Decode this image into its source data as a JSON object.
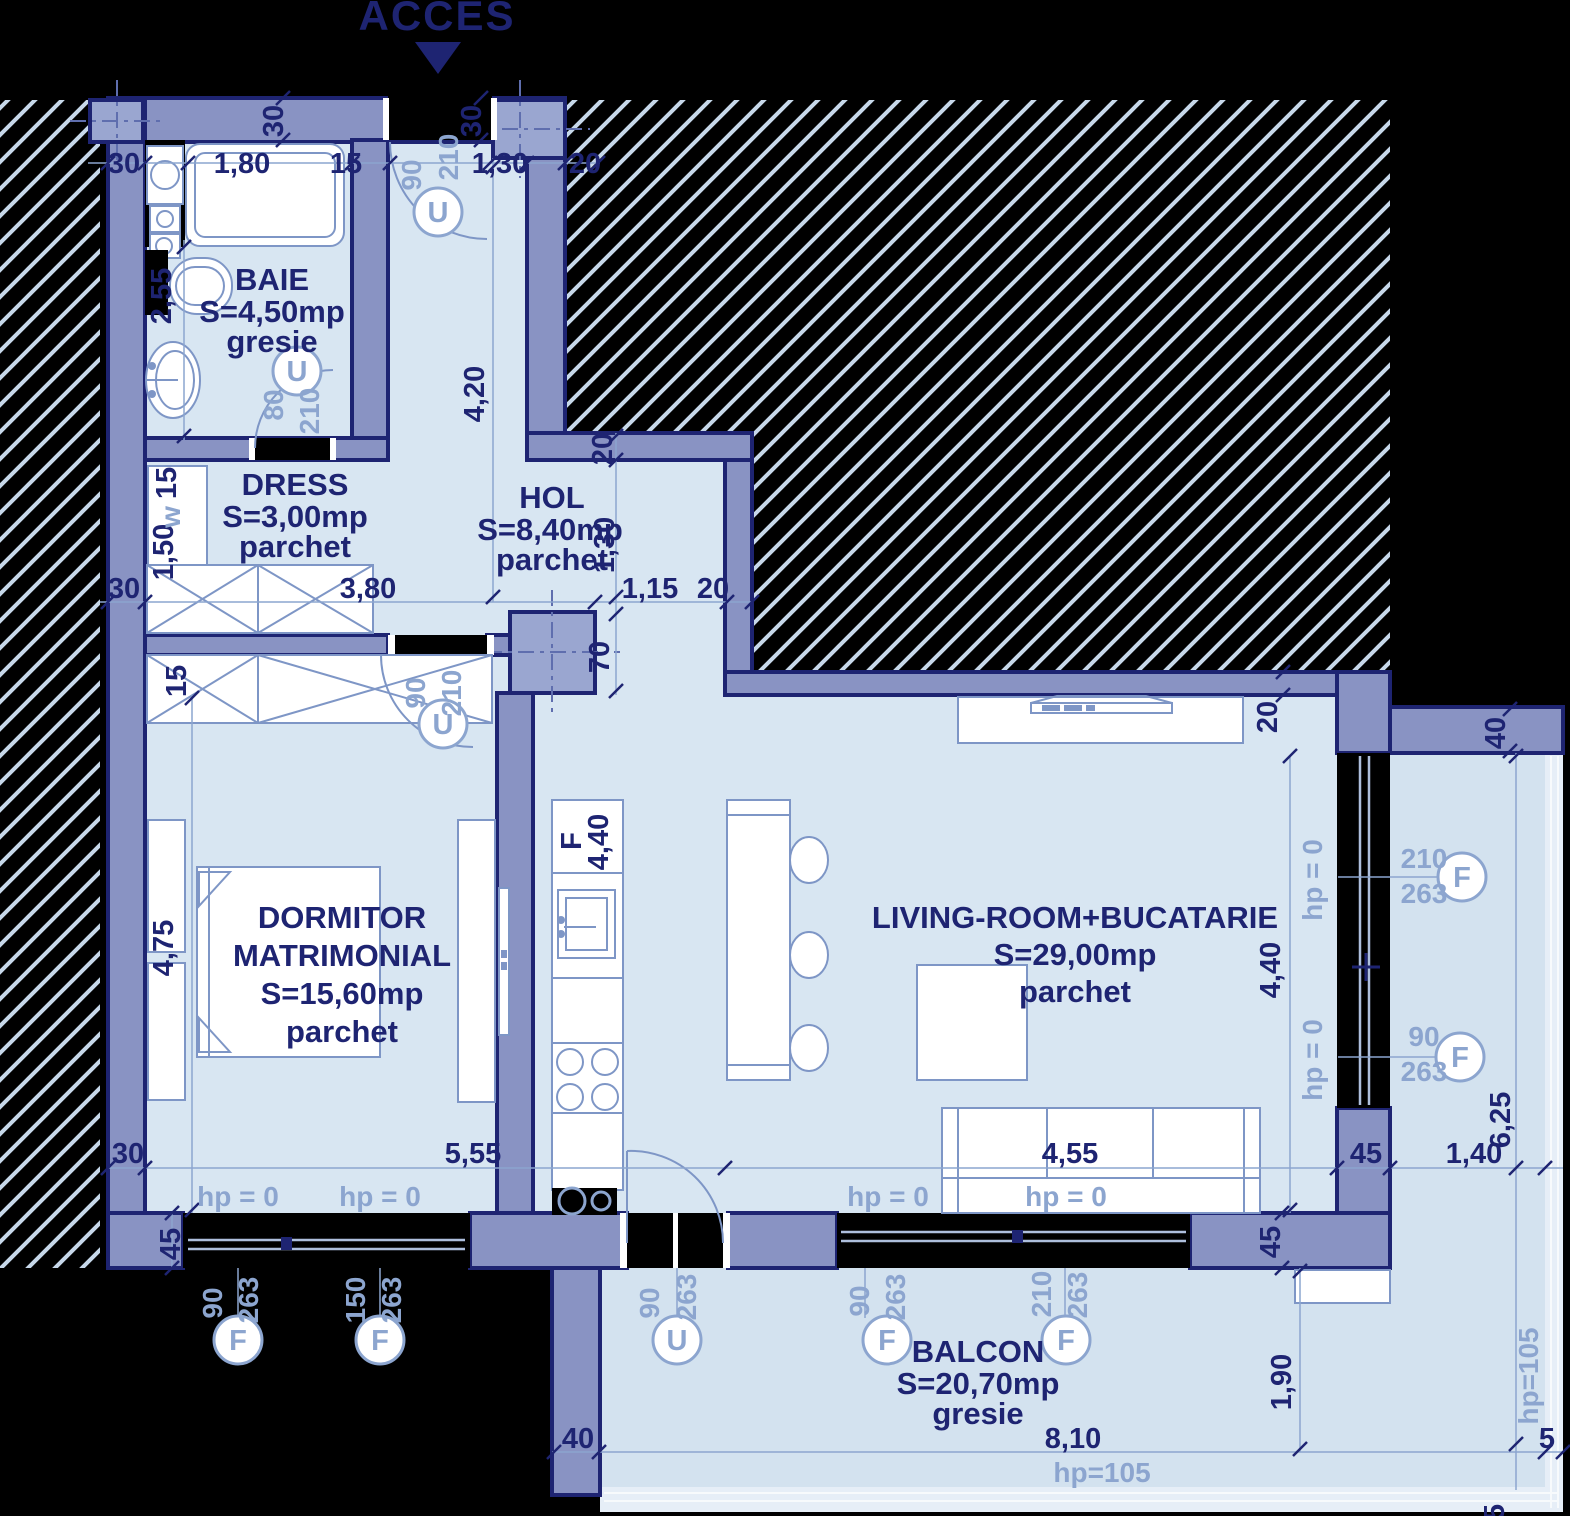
{
  "colors": {
    "background": "#000000",
    "navy_outline": "#1e2472",
    "wall_fill": "#8993c3",
    "column_fill": "#9aa6d0",
    "room_fill": "#d8e6f2",
    "balcony_fill": "#d3e2ef",
    "hatch_line": "#c7d8ea",
    "light_label": "#8ca5cf",
    "fixture_stroke": "#7e96c6"
  },
  "title": {
    "acces": "ACCES"
  },
  "rooms": {
    "baie": {
      "name": "BAIE",
      "area": "S=4,50mp",
      "floor": "gresie"
    },
    "dress": {
      "name": "DRESS",
      "area": "S=3,00mp",
      "floor": "parchet"
    },
    "hol": {
      "name": "HOL",
      "area": "S=8,40mp",
      "floor": "parchet"
    },
    "dormitor": {
      "name_line1": "DORMITOR",
      "name_line2": "MATRIMONIAL",
      "area": "S=15,60mp",
      "floor": "parchet"
    },
    "living": {
      "name": "LIVING-ROOM+BUCATARIE",
      "area": "S=29,00mp",
      "floor": "parchet"
    },
    "balcon": {
      "name": "BALCON",
      "area": "S=20,70mp",
      "floor": "gresie"
    }
  },
  "dims": {
    "d5": "5",
    "d15": "15",
    "d20": "20",
    "d30": "30",
    "d40": "40",
    "d45": "45",
    "d70": "70",
    "d80": "80",
    "d90": "90",
    "d150": "150",
    "d210": "210",
    "d263": "263",
    "d115": "1,15",
    "d130": "1,30",
    "d140": "1,40",
    "d150m": "1,50",
    "d180": "1,80",
    "d190": "1,90",
    "d255": "2,55",
    "d380": "3,80",
    "d420": "4,20",
    "d440": "4,40",
    "d455": "4,55",
    "d475": "4,75",
    "d555": "5,55",
    "d625": "6,25",
    "d810": "8,10"
  },
  "window_labels": {
    "hp0": "hp = 0",
    "hp105": "hp=105"
  },
  "door_labels": {
    "u": "U",
    "f": "F",
    "w": "w"
  }
}
